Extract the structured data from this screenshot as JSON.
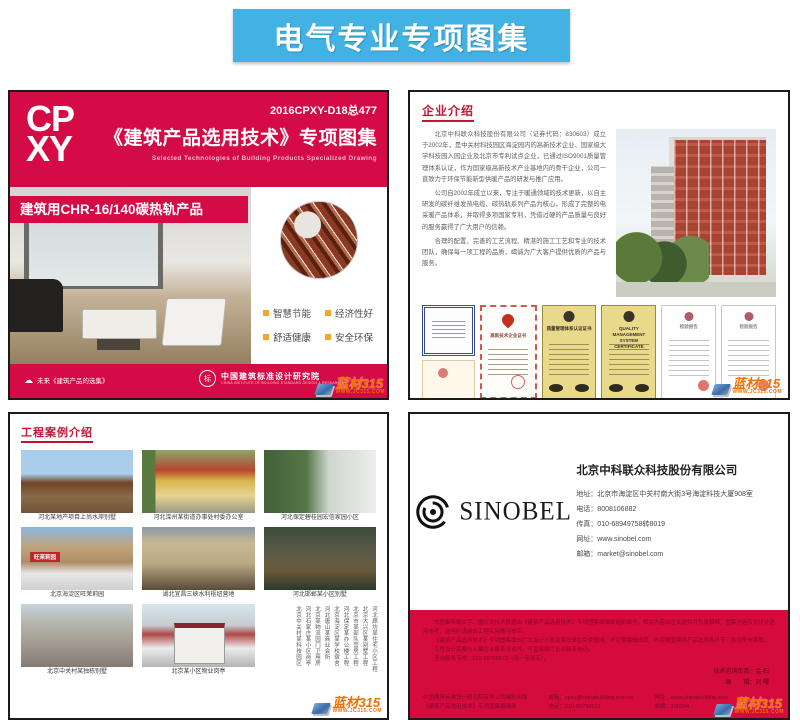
{
  "banner": {
    "title": "电气专业专项图集"
  },
  "watermark": {
    "text": "蓝材315",
    "url": "WWW.JC315.COM"
  },
  "panel1": {
    "logo_top": "CP",
    "logo_bottom": "XY",
    "code": "2016CPXY-D18总477",
    "title": "《建筑产品选用技术》专项图集",
    "subtitle": "Selected Technologies of Building Products Specialized Drawing",
    "product_banner": "建筑用CHR-16/140碳热轨产品",
    "features": [
      {
        "label": "智慧节能"
      },
      {
        "label": "经济性好"
      },
      {
        "label": "舒适健康"
      },
      {
        "label": "安全环保"
      }
    ],
    "footer_left": "未来《建筑产品的选集》",
    "footer_org": "中国建筑标准设计研究院",
    "footer_org_en": "CHINA INSTITUTE OF BUILDING STANDARD DESIGN & RESEARCH",
    "footer_org_mark": "标"
  },
  "panel2": {
    "title": "企业介绍",
    "paragraphs": [
      {
        "text": "北京中科联众科技股份有限公司（证券代码：830603）成立于2002年，是中关村科技园区海淀园内的高新技术企业、国家级大学科技园入园企业及北京市专利试点企业，已通过ISO9001质量管理体系认证，作为国家级高新技术产业基地内的骨干企业，公司一直致力于环保节能新型供暖产品的研发与推广应用。"
      },
      {
        "text": "公司自2002年成立以来，专注于暖通领域的技术更新，以自主研发的碳纤维发热电缆、碳热轨系列产品为核心，形成了完整的电采暖产品体系，并取得多项国家专利，凭借过硬的产品质量与良好的服务赢得了广大用户的信赖。"
      },
      {
        "text": "合理的配置、完善的工艺流程、精湛的施工工艺和专业的技术团队，确保每一项工程的品质，竭诚为广大客户提供优质的产品与服务。"
      }
    ],
    "certificates": [
      {
        "title": "荣誉证书"
      },
      {
        "title": "高新技术企业证书"
      },
      {
        "title": "质量管理体系认证证书"
      },
      {
        "title": "QUALITY MANAGEMENT SYSTEM CERTIFICATE"
      },
      {
        "title": "检验报告"
      },
      {
        "title": "检验报告"
      }
    ]
  },
  "panel3": {
    "title": "工程案例介绍",
    "photos": [
      {
        "caption": "河北某地产项目上尚水岸别墅"
      },
      {
        "caption": "河北滦州某街道办事处村委办公室"
      },
      {
        "caption": "河北保定碧桂园宏信家园小区"
      },
      {
        "caption": "北京海淀区旺茉莉园",
        "sign": "旺茉莉园"
      },
      {
        "caption": "湖北宜昌三峡水利枢纽营地"
      },
      {
        "caption": "河北邯郸某小区别墅"
      },
      {
        "caption": "北京中关村某独栋别墅"
      },
      {
        "caption": "北京某小区物业岗亭"
      }
    ],
    "project_list": [
      {
        "name": "河北廊坊某住宅小区工程"
      },
      {
        "name": "北京大兴区某别墅工程"
      },
      {
        "name": "北京市某部队营房工程"
      },
      {
        "name": "河北保定某办公楼工程"
      },
      {
        "name": "北京海淀区某学校宿舍"
      },
      {
        "name": "河北唐山某商业会所"
      },
      {
        "name": "北京某物流园门卫用房"
      },
      {
        "name": "河北石家庄某小区岗亭"
      },
      {
        "name": "北京中关村某科技园区"
      }
    ]
  },
  "panel4": {
    "logo_text": "SINOBEL",
    "company": "北京中科联众科技股份有限公司",
    "contacts": [
      {
        "line": "地址：北京市海淀区中关村南大街3号海淀科技大厦908室"
      },
      {
        "line": "电话：8008106882"
      },
      {
        "line": "传真：010-68949758转8019"
      },
      {
        "line": "网址：www.sinobel.com"
      },
      {
        "line": "邮箱：market@sinobel.com"
      }
    ],
    "notice": [
      {
        "text": "本图集所载文字、图片及技术数据由《建筑产品选用技术》专项图集编辑部组织编写，相关内容由企业提供并负责解释，图集内容仅供设计选用参考，选用时请结合工程实际情况核实。"
      },
      {
        "text": "《建筑产品选用技术》专项图集面向广大设计人员及建设单位免费赠阅，不定期编辑出版，内容覆盖建筑产品选用各环节，欢迎来电索取。"
      },
      {
        "text": "工程设计需要与入编企业联系洽谈时，可直接拨打企业联系电话。"
      },
      {
        "text": "咨询服务专线：010-68799573（周一至周五）。"
      }
    ],
    "credits": [
      {
        "line": "技术咨询负责：金 石"
      },
      {
        "line": "编　　辑：刘 曙"
      }
    ],
    "footer_cols": [
      {
        "l1": "中国建筑标准设计研究院有限公司编制出版",
        "l2": "《建筑产品选用技术》专项图集编辑部"
      },
      {
        "l1": "邮箱：cpxy@chinabuilding.com.cn",
        "l2": "电话：010-68799573"
      },
      {
        "l1": "网址：www.chinabuilding.com",
        "l2": "邮编：100044"
      }
    ]
  }
}
